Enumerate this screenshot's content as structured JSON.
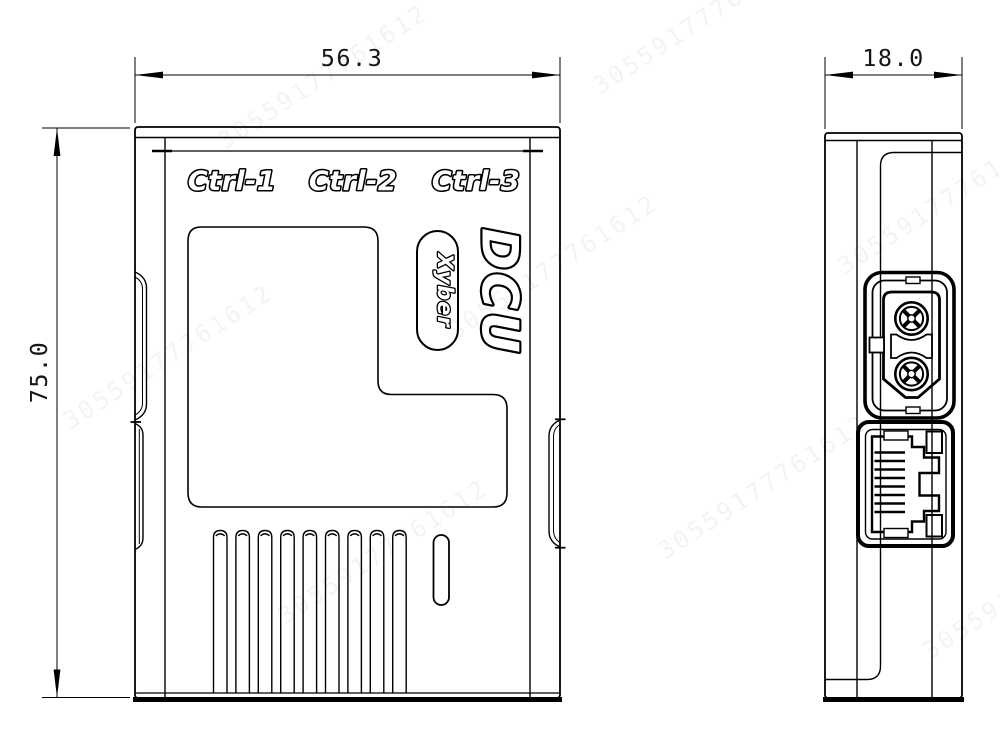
{
  "labels": {
    "ctrl1": "Ctrl-1",
    "ctrl2": "Ctrl-2",
    "ctrl3": "Ctrl-3",
    "product": "DCU",
    "brand": "Xyber"
  },
  "dimensions": {
    "front_width": "56.3",
    "front_height": "75.0",
    "side_depth": "18.0"
  },
  "watermark": {
    "text": "30559177761612"
  },
  "colors": {
    "line": "#000000",
    "background": "#ffffff"
  }
}
